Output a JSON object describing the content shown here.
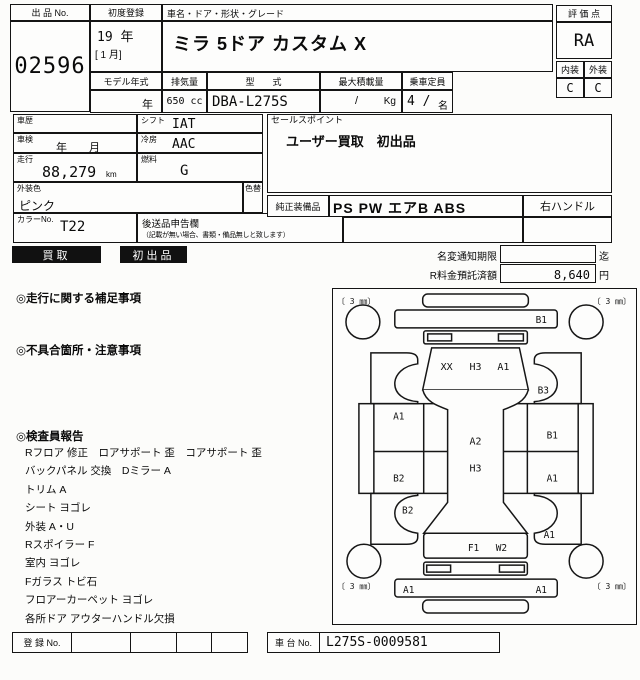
{
  "header": {
    "auction_no_label": "出 品 No.",
    "auction_no": "02596",
    "first_reg_label": "初度登録",
    "first_reg_year": "19 年",
    "first_reg_month": "[ 1 月]",
    "car_name_label": "車名・ドア・形状・グレード",
    "car_name": "ミラ 5ドア カスタム X",
    "model_year_label": "モデル年式",
    "model_year": "年",
    "displacement_label": "排気量",
    "displacement": "650 cc",
    "model_code_label": "型　　式",
    "model_code": "DBA-L275S",
    "max_load_label": "最大積載量",
    "max_load_value": "/",
    "max_load_unit": "Kg",
    "capacity_label": "乗車定員",
    "capacity_value": "4 /",
    "capacity_unit": "名",
    "score_label": "評 価 点",
    "score": "RA",
    "interior_label": "内装",
    "interior": "C",
    "exterior_label": "外装",
    "exterior": "C"
  },
  "details": {
    "history_label": "車歴",
    "shift_label": "シフト",
    "shift": "IAT",
    "inspection_label": "車検",
    "inspection": "年　　月",
    "ac_label": "冷房",
    "ac": "AAC",
    "mileage_label": "走行",
    "mileage": "88,279",
    "mileage_unit": "km",
    "fuel_label": "燃料",
    "fuel": "G",
    "body_color_label": "外装色",
    "body_color": "ピンク",
    "color_change_label": "色替",
    "color_no_label": "カラーNo.",
    "color_no": "T22",
    "later_items_label": "後送品申告欄",
    "later_items_note": "（記載が無い場合、書類・備品無しと致します）",
    "sales_point_label": "セールスポイント",
    "sales_point": "ユーザー買取　初出品",
    "equipment_label": "純正装備品",
    "equipment": "PS PW エアB ABS",
    "steering": "右ハンドル"
  },
  "badges": {
    "buyback": "買取",
    "first_listing": "初出品"
  },
  "fees": {
    "name_change_label": "名変通知期限",
    "name_change_suffix": "迄",
    "recycle_label": "R料金預託済額",
    "recycle_amount": "8,640",
    "recycle_unit": "円"
  },
  "notes": {
    "mileage_supplement_label": "◎走行に関する補足事項",
    "defects_label": "◎不具合箇所・注意事項",
    "inspector_label": "◎検査員報告",
    "inspector_lines": [
      "Rフロア 修正　ロアサポート 歪　コアサポート 歪",
      "バックパネル 交換　Dミラー A",
      "トリム A",
      "シート ヨゴレ",
      "外装 A・U",
      "Rスポイラー F",
      "室内 ヨゴレ",
      "Fガラス トビ石",
      "フロアーカーペット ヨゴレ",
      "各所ドア アウターハンドル欠損"
    ]
  },
  "diagram": {
    "tread": "〔 3 ㎜〕",
    "front_bumper": "B1",
    "hood": [
      "XX",
      "H3",
      "A1"
    ],
    "right_front_fender": "B3",
    "left_door": "A1",
    "left_door_lower": "B2",
    "left_rear_fender": "B2",
    "right_door": "B1",
    "right_door_lower": "A1",
    "right_rear_fender": "A1",
    "roof_upper": "A2",
    "roof_lower": "H3",
    "rear_panel": [
      "F1",
      "W2"
    ],
    "rear_bumper_left": "A1",
    "rear_bumper_right": "A1"
  },
  "footer": {
    "reg_no_label": "登 録 No.",
    "chassis_no_label": "車 台 No.",
    "chassis_no": "L275S-0009581"
  }
}
